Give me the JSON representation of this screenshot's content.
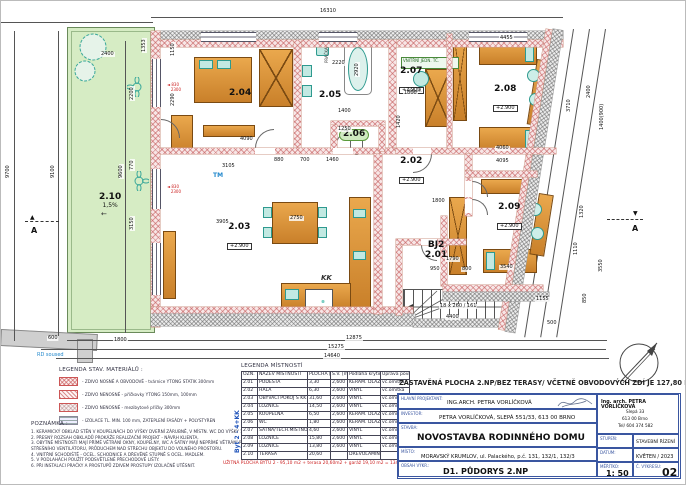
{
  "plan": {
    "dims": [
      {
        "t": "16310",
        "x": 318,
        "y": 8
      },
      {
        "t": "9700",
        "x": 5,
        "y": 178,
        "v": 1
      },
      {
        "t": "9100",
        "x": 50,
        "y": 178,
        "v": 1
      },
      {
        "t": "9600",
        "x": 118,
        "y": 178,
        "v": 1
      },
      {
        "t": "2400",
        "x": 99,
        "y": 51
      },
      {
        "t": "1353",
        "x": 141,
        "y": 52,
        "v": 1
      },
      {
        "t": "2200",
        "x": 129,
        "y": 100,
        "v": 1
      },
      {
        "t": "770",
        "x": 129,
        "y": 170,
        "v": 1
      },
      {
        "t": "3150",
        "x": 129,
        "y": 230,
        "v": 1
      },
      {
        "t": "1150",
        "x": 170,
        "y": 56,
        "v": 1
      },
      {
        "t": "2290",
        "x": 170,
        "y": 106,
        "v": 1
      },
      {
        "t": "4090",
        "x": 238,
        "y": 136
      },
      {
        "t": "3105",
        "x": 220,
        "y": 163
      },
      {
        "t": "3905",
        "x": 214,
        "y": 219
      },
      {
        "t": "2750",
        "x": 288,
        "y": 215
      },
      {
        "t": "1420",
        "x": 396,
        "y": 128,
        "v": 1
      },
      {
        "t": "880",
        "x": 272,
        "y": 157
      },
      {
        "t": "700",
        "x": 298,
        "y": 157
      },
      {
        "t": "1460",
        "x": 324,
        "y": 157
      },
      {
        "t": "1250",
        "x": 336,
        "y": 126
      },
      {
        "t": "1400",
        "x": 336,
        "y": 108
      },
      {
        "t": "2220",
        "x": 330,
        "y": 60
      },
      {
        "t": "2920",
        "x": 354,
        "y": 76,
        "v": 1
      },
      {
        "t": "1800",
        "x": 402,
        "y": 90
      },
      {
        "t": "4455",
        "x": 498,
        "y": 35
      },
      {
        "t": "3710",
        "x": 566,
        "y": 112,
        "v": 1
      },
      {
        "t": "4060",
        "x": 494,
        "y": 145
      },
      {
        "t": "4095",
        "x": 494,
        "y": 158
      },
      {
        "t": "1800",
        "x": 430,
        "y": 198
      },
      {
        "t": "3540",
        "x": 498,
        "y": 264
      },
      {
        "t": "1155",
        "x": 534,
        "y": 296
      },
      {
        "t": "18 x 260 / 161",
        "x": 438,
        "y": 303
      },
      {
        "t": "4400",
        "x": 444,
        "y": 314
      },
      {
        "t": "950",
        "x": 428,
        "y": 266
      },
      {
        "t": "800",
        "x": 460,
        "y": 266
      },
      {
        "t": "1790",
        "x": 444,
        "y": 256
      },
      {
        "t": "600",
        "x": 46,
        "y": 335
      },
      {
        "t": "1800",
        "x": 112,
        "y": 337
      },
      {
        "t": "12875",
        "x": 344,
        "y": 335
      },
      {
        "t": "15275",
        "x": 326,
        "y": 344
      },
      {
        "t": "14640",
        "x": 322,
        "y": 353
      },
      {
        "t": "3550",
        "x": 598,
        "y": 272,
        "v": 1
      },
      {
        "t": "1110",
        "x": 573,
        "y": 255,
        "v": 1
      },
      {
        "t": "2400",
        "x": 586,
        "y": 98,
        "v": 1
      },
      {
        "t": "1400(900)",
        "x": 599,
        "y": 130,
        "v": 1
      },
      {
        "t": "1320",
        "x": 579,
        "y": 218,
        "v": 1
      },
      {
        "t": "850",
        "x": 582,
        "y": 303,
        "v": 1
      },
      {
        "t": "500",
        "x": 545,
        "y": 320
      }
    ],
    "texts": [
      {
        "t": "PRAČKA",
        "x": 324,
        "y": 62,
        "v": 1,
        "fs": 4,
        "c": "#444"
      },
      {
        "t": "BOJLER",
        "x": 406,
        "y": 88,
        "fs": 4,
        "c": "#444"
      },
      {
        "t": "VNITŘNÍ JEDN. TČ.",
        "x": 402,
        "y": 58,
        "fs": 4,
        "c": "#2a6a2a"
      },
      {
        "t": "TM",
        "x": 212,
        "y": 172,
        "fs": 6,
        "c": "#2288cc",
        "b": 1
      },
      {
        "t": "KK",
        "x": 320,
        "y": 274,
        "fs": 7,
        "c": "#333",
        "b": 1,
        "i": 1
      },
      {
        "t": "RD soused",
        "x": 36,
        "y": 352,
        "fs": 5,
        "c": "#2288cc"
      },
      {
        "t": "A",
        "x": 30,
        "y": 226,
        "fs": 8,
        "c": "#111",
        "b": 1
      },
      {
        "t": "▲",
        "x": 29,
        "y": 214,
        "fs": 6,
        "c": "#111"
      },
      {
        "t": "A",
        "x": 631,
        "y": 224,
        "fs": 8,
        "c": "#111",
        "b": 1
      },
      {
        "t": "▼",
        "x": 632,
        "y": 210,
        "fs": 6,
        "c": "#111"
      },
      {
        "t": "←",
        "x": 100,
        "y": 210,
        "fs": 7,
        "c": "#333"
      }
    ],
    "rooms": [
      {
        "id": "2.04",
        "x": 228,
        "y": 88
      },
      {
        "id": "2.05",
        "x": 318,
        "y": 90
      },
      {
        "id": "2.06",
        "x": 338,
        "y": 128,
        "pill": 1
      },
      {
        "id": "2.07",
        "elev": "+2.900",
        "x": 398,
        "y": 66
      },
      {
        "id": "2.08",
        "elev": "+2.900",
        "x": 492,
        "y": 84
      },
      {
        "id": "2.02",
        "elev": "+2.900",
        "x": 398,
        "y": 156
      },
      {
        "id": "2.03",
        "elev": "+2.900",
        "x": 226,
        "y": 222
      },
      {
        "id": "2.09",
        "elev": "+2.900",
        "x": 496,
        "y": 202
      },
      {
        "id": "2.01",
        "pre": "BJ2",
        "x": 424,
        "y": 240
      },
      {
        "id": "2.10",
        "sub": "1,5%",
        "x": 98,
        "y": 192
      }
    ],
    "red_marks": [
      {
        "a": "830",
        "b": "2300",
        "x": 166,
        "y": 82
      },
      {
        "a": "830",
        "b": "2300",
        "x": 166,
        "y": 184
      }
    ]
  },
  "legend_materials": {
    "title": "LEGENDA STAV. MATERIÁLŮ :",
    "items": [
      {
        "swatch": "cross-pink",
        "label": "- ZDIVO NOSNÉ A OBVODOVÉ - tvárnice YTONG STATIK 300mm"
      },
      {
        "swatch": "diag-pink",
        "label": "- ZDIVO NENOSNÉ - příčkovky YTONG 150mm, 100mm"
      },
      {
        "swatch": "cross-light",
        "label": "- ZDIVO NENOSNÉ - mezibytové příčky 300mm"
      },
      {
        "swatch": "lines-gray",
        "label": "- IZOLACE TL. MIN. 100 mm, ZATEPLENÍ FASÁDY + POLYSTYREN"
      }
    ]
  },
  "notes": {
    "title": "POZNÁMKA :",
    "lines": [
      "1. KERAMICKÝ OBKLAD STĚN V KOUPELNÁCH DO VÝŠKY DVEŘNÍ ZÁRUBNĚ, V MÍSTN. WC DO VÝŠKY 1,5 M,",
      "2. PŘESNÝ ROZSAH OBKLADŮ PROKÁŽE REALIZAČNÍ PROJEKT - NÁVRH KLIENTA.",
      "3. OBYTNÉ MÍSTNOSTI MAJÍ PŘÍMÉ VĚTRÁNÍ OKNY, KOUPELNY, WC A ŠATNY MAJÍ NEPŘÍMÉ VĚTRÁNÍ POMOCÍ",
      "    STŘEŠNÍHO VENTILÁTORU, PRŮDUCHEM NAD STŘECHU OBJEKTU DO VOLNÉHO PROSTORU.",
      "4. VNITŘNÍ SCHODIŠTĚ - OCEL. SCHODNICE A DŘEVĚNÉ STUPNĚ S OCEL. MADLEM.",
      "5. V PODLAHÁCH POUŽÍT PODSVĚTLENÉ PŘECHODOVÉ LIŠTY.",
      "6. PŘI INSTALACI PRAČKY A PROSTUPŮ ZDIVEM PROSTUPY IZOLAČNĚ UTĚSNIT."
    ]
  },
  "room_table": {
    "title": "LEGENDA MÍSTNOSTÍ",
    "side_label": "Byt 2 - 4+KK",
    "headers": [
      "OZN.",
      "NÁZEV MÍSTNOSTI",
      "PLOCHA [m²]",
      "S.V. [m]",
      "Podlaha krytina",
      "Úprava povrchů"
    ],
    "rows": [
      [
        "2.01",
        "PODESTA",
        "3,30",
        "2,600",
        "KERAM. DLAŽBA",
        "vc.omítka"
      ],
      [
        "2.02",
        "HALA",
        "6,30",
        "2,600",
        "VINYL",
        "vc.omítka"
      ],
      [
        "2.03",
        "OBÝVACÍ POKOJ S KK",
        "31,60",
        "2,600",
        "VINYL",
        "vc.omítka/ker.obkl."
      ],
      [
        "2.04",
        "LOŽNICE",
        "14,50",
        "2,600",
        "VINYL",
        "vc.omítka"
      ],
      [
        "2.05",
        "KOUPELNA",
        "6,50",
        "2,600",
        "KERAM. DLAŽBA",
        "vc.omítka/ker.obkl."
      ],
      [
        "2.06",
        "WC",
        "1,80",
        "2,600",
        "KERAM. DLAŽBA",
        "vc.omítka/ker.obkl."
      ],
      [
        "2.07",
        "ŠATNA/TECH.MÍSTNOST",
        "4,60",
        "2,600",
        "VINYL",
        "vc.omítka"
      ],
      [
        "2.08",
        "LOŽNICE",
        "15,80",
        "2,600",
        "VINYL",
        "vc.omítka"
      ],
      [
        "2.09",
        "LOŽNICE",
        "13,80",
        "2,600",
        "VINYL",
        "vc.omítka"
      ],
      [
        "2.10",
        "TERASA",
        "20,60",
        "",
        "DŘEVOLAMINÁT",
        ""
      ]
    ],
    "footer": "UŽITNÁ PLOCHA BYTU 2 - 95,10 m2 + terasa 20,60m2 + garáž 19,10 m2 = 134,80 m2"
  },
  "title_block": {
    "area_note": "ZASTAVĚNÁ PLOCHA 2.NP/BEZ TERASY/ VČETNĚ OBVODOVÝCH ZDÍ JE 127,80 M2.",
    "projektant_label": "HLAVNÍ PROJEKTANT:",
    "projektant": "ING.ARCH. PETRA VORLÍČKOVÁ",
    "investor_label": "INVESTOR:",
    "investor": "PETRA VORLÍČKOVÁ, SLEPÁ 551/33, 613 00 BRNO",
    "stavba_label": "STAVBA:",
    "stavba": "NOVOSTAVBA RODINNÉHO DOMU",
    "misto_label": "MÍSTO:",
    "misto": "MORAVSKÝ KRUMLOV, ul. Palackého, p.č. 131, 132/1, 132/3",
    "obsah_label": "OBSAH VÝKR.:",
    "obsah": "D1. PŮDORYS 2.NP",
    "card": {
      "name": "Ing. arch. PETRA VORLÍČKOVÁ",
      "addr1": "Slepá 33",
      "addr2": "613 00 Brno",
      "tel": "Tel/ 604 374 582"
    },
    "stupen_label": "STUPEŇ:",
    "stupen": "STAVEBNÍ ŘÍZENÍ",
    "datum_label": "DATUM:",
    "datum": "KVĚTEN / 2023",
    "meritko_label": "MĚŘÍTKO:",
    "meritko": "1: 50",
    "cvykresu_label": "Č. VÝKRESU:",
    "cvykresu": "02"
  }
}
